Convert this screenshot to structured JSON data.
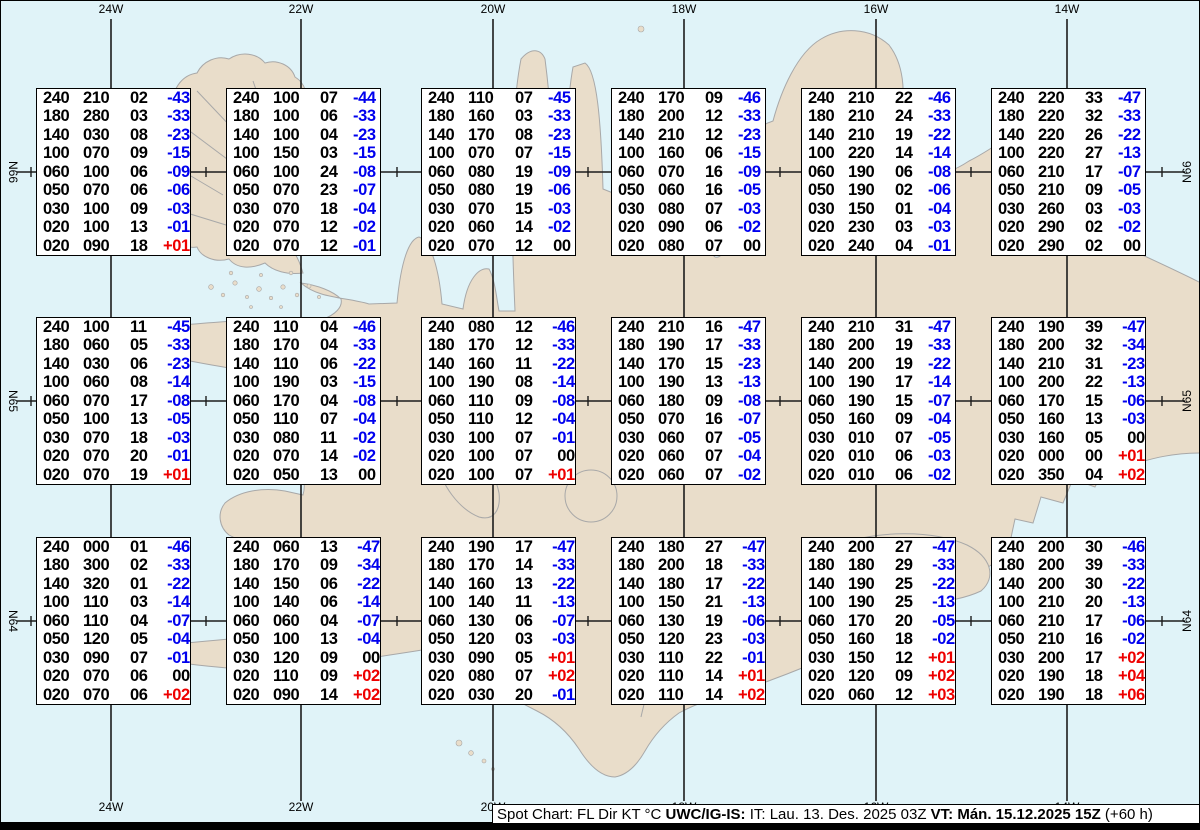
{
  "title": "Spot wind and temperature chart, Iceland",
  "colors": {
    "ocean": "#E0F3F8",
    "land": "#E9DDCA",
    "coast": "#A8A8A8",
    "grid": "#1C1C1C",
    "neg_temp": "#0000EE",
    "pos_temp": "#EE0000",
    "text": "#000000",
    "box_bg": "#FFFFFF",
    "frame": "#000000",
    "bar": "#000000"
  },
  "map": {
    "longitude_labels": [
      "24W",
      "22W",
      "20W",
      "18W",
      "16W",
      "14W"
    ],
    "longitudes_x": [
      110,
      300,
      492,
      683,
      875,
      1066
    ],
    "latitude_labels": [
      "N66",
      "N65",
      "N64"
    ],
    "latitudes_y": [
      171,
      400,
      620
    ],
    "tick_x": [
      30,
      205,
      396,
      587,
      779,
      970,
      1161
    ],
    "box_left_x": [
      35,
      225,
      420,
      610,
      800,
      990
    ],
    "box_top_y": [
      87,
      316,
      536
    ]
  },
  "legend": {
    "segments": [
      {
        "text": "Spot Chart: FL Dir KT °C ",
        "bold": false
      },
      {
        "text": "UWC/IG-IS:",
        "bold": true
      },
      {
        "text": " IT: Lau. 13. Des. 2025 03Z ",
        "bold": false
      },
      {
        "text": "VT: Mán. 15.12.2025 15Z",
        "bold": true
      },
      {
        "text": " (+60 h)",
        "bold": false
      }
    ]
  },
  "columns": [
    "FL",
    "Dir",
    "KT",
    "°C"
  ],
  "boxes": [
    {
      "row": 0,
      "col": 0,
      "rows": [
        [
          "240",
          "210",
          "02",
          "-43"
        ],
        [
          "180",
          "280",
          "03",
          "-33"
        ],
        [
          "140",
          "030",
          "08",
          "-23"
        ],
        [
          "100",
          "070",
          "09",
          "-15"
        ],
        [
          "060",
          "100",
          "06",
          "-09"
        ],
        [
          "050",
          "070",
          "06",
          "-06"
        ],
        [
          "030",
          "100",
          "09",
          "-03"
        ],
        [
          "020",
          "100",
          "13",
          "-01"
        ],
        [
          "020",
          "090",
          "18",
          "+01"
        ]
      ]
    },
    {
      "row": 0,
      "col": 1,
      "rows": [
        [
          "240",
          "100",
          "07",
          "-44"
        ],
        [
          "180",
          "100",
          "06",
          "-33"
        ],
        [
          "140",
          "100",
          "04",
          "-23"
        ],
        [
          "100",
          "150",
          "03",
          "-15"
        ],
        [
          "060",
          "100",
          "24",
          "-08"
        ],
        [
          "050",
          "070",
          "23",
          "-07"
        ],
        [
          "030",
          "070",
          "18",
          "-04"
        ],
        [
          "020",
          "070",
          "12",
          "-02"
        ],
        [
          "020",
          "070",
          "12",
          "-01"
        ]
      ]
    },
    {
      "row": 0,
      "col": 2,
      "rows": [
        [
          "240",
          "110",
          "07",
          "-45"
        ],
        [
          "180",
          "160",
          "03",
          "-33"
        ],
        [
          "140",
          "170",
          "08",
          "-23"
        ],
        [
          "100",
          "070",
          "07",
          "-15"
        ],
        [
          "060",
          "080",
          "19",
          "-09"
        ],
        [
          "050",
          "080",
          "19",
          "-06"
        ],
        [
          "030",
          "070",
          "15",
          "-03"
        ],
        [
          "020",
          "060",
          "14",
          "-02"
        ],
        [
          "020",
          "070",
          "12",
          "00"
        ]
      ]
    },
    {
      "row": 0,
      "col": 3,
      "rows": [
        [
          "240",
          "170",
          "09",
          "-46"
        ],
        [
          "180",
          "200",
          "12",
          "-33"
        ],
        [
          "140",
          "210",
          "12",
          "-23"
        ],
        [
          "100",
          "160",
          "06",
          "-15"
        ],
        [
          "060",
          "070",
          "16",
          "-09"
        ],
        [
          "050",
          "060",
          "16",
          "-05"
        ],
        [
          "030",
          "080",
          "07",
          "-03"
        ],
        [
          "020",
          "090",
          "06",
          "-02"
        ],
        [
          "020",
          "080",
          "07",
          "00"
        ]
      ]
    },
    {
      "row": 0,
      "col": 4,
      "rows": [
        [
          "240",
          "210",
          "22",
          "-46"
        ],
        [
          "180",
          "210",
          "24",
          "-33"
        ],
        [
          "140",
          "210",
          "19",
          "-22"
        ],
        [
          "100",
          "220",
          "14",
          "-14"
        ],
        [
          "060",
          "190",
          "06",
          "-08"
        ],
        [
          "050",
          "190",
          "02",
          "-06"
        ],
        [
          "030",
          "150",
          "01",
          "-04"
        ],
        [
          "020",
          "230",
          "03",
          "-03"
        ],
        [
          "020",
          "240",
          "04",
          "-01"
        ]
      ]
    },
    {
      "row": 0,
      "col": 5,
      "rows": [
        [
          "240",
          "220",
          "33",
          "-47"
        ],
        [
          "180",
          "220",
          "32",
          "-33"
        ],
        [
          "140",
          "220",
          "26",
          "-22"
        ],
        [
          "100",
          "220",
          "27",
          "-13"
        ],
        [
          "060",
          "210",
          "17",
          "-07"
        ],
        [
          "050",
          "210",
          "09",
          "-05"
        ],
        [
          "030",
          "260",
          "03",
          "-03"
        ],
        [
          "020",
          "290",
          "02",
          "-02"
        ],
        [
          "020",
          "290",
          "02",
          "00"
        ]
      ]
    },
    {
      "row": 1,
      "col": 0,
      "rows": [
        [
          "240",
          "100",
          "11",
          "-45"
        ],
        [
          "180",
          "060",
          "05",
          "-33"
        ],
        [
          "140",
          "030",
          "06",
          "-23"
        ],
        [
          "100",
          "060",
          "08",
          "-14"
        ],
        [
          "060",
          "070",
          "17",
          "-08"
        ],
        [
          "050",
          "100",
          "13",
          "-05"
        ],
        [
          "030",
          "070",
          "18",
          "-03"
        ],
        [
          "020",
          "070",
          "20",
          "-01"
        ],
        [
          "020",
          "070",
          "19",
          "+01"
        ]
      ]
    },
    {
      "row": 1,
      "col": 1,
      "rows": [
        [
          "240",
          "110",
          "04",
          "-46"
        ],
        [
          "180",
          "170",
          "04",
          "-33"
        ],
        [
          "140",
          "110",
          "06",
          "-22"
        ],
        [
          "100",
          "190",
          "03",
          "-15"
        ],
        [
          "060",
          "170",
          "04",
          "-08"
        ],
        [
          "050",
          "110",
          "07",
          "-04"
        ],
        [
          "030",
          "080",
          "11",
          "-02"
        ],
        [
          "020",
          "070",
          "14",
          "-02"
        ],
        [
          "020",
          "050",
          "13",
          "00"
        ]
      ]
    },
    {
      "row": 1,
      "col": 2,
      "rows": [
        [
          "240",
          "080",
          "12",
          "-46"
        ],
        [
          "180",
          "170",
          "12",
          "-33"
        ],
        [
          "140",
          "160",
          "11",
          "-22"
        ],
        [
          "100",
          "190",
          "08",
          "-14"
        ],
        [
          "060",
          "110",
          "09",
          "-08"
        ],
        [
          "050",
          "110",
          "12",
          "-04"
        ],
        [
          "030",
          "100",
          "07",
          "-01"
        ],
        [
          "020",
          "100",
          "07",
          "00"
        ],
        [
          "020",
          "100",
          "07",
          "+01"
        ]
      ]
    },
    {
      "row": 1,
      "col": 3,
      "rows": [
        [
          "240",
          "210",
          "16",
          "-47"
        ],
        [
          "180",
          "190",
          "17",
          "-33"
        ],
        [
          "140",
          "170",
          "15",
          "-23"
        ],
        [
          "100",
          "190",
          "13",
          "-13"
        ],
        [
          "060",
          "180",
          "09",
          "-08"
        ],
        [
          "050",
          "070",
          "16",
          "-07"
        ],
        [
          "030",
          "060",
          "07",
          "-05"
        ],
        [
          "020",
          "060",
          "07",
          "-04"
        ],
        [
          "020",
          "060",
          "07",
          "-02"
        ]
      ]
    },
    {
      "row": 1,
      "col": 4,
      "rows": [
        [
          "240",
          "210",
          "31",
          "-47"
        ],
        [
          "180",
          "200",
          "19",
          "-33"
        ],
        [
          "140",
          "200",
          "19",
          "-22"
        ],
        [
          "100",
          "190",
          "17",
          "-14"
        ],
        [
          "060",
          "190",
          "15",
          "-07"
        ],
        [
          "050",
          "160",
          "09",
          "-04"
        ],
        [
          "030",
          "010",
          "07",
          "-05"
        ],
        [
          "020",
          "010",
          "06",
          "-03"
        ],
        [
          "020",
          "010",
          "06",
          "-02"
        ]
      ]
    },
    {
      "row": 1,
      "col": 5,
      "rows": [
        [
          "240",
          "190",
          "39",
          "-47"
        ],
        [
          "180",
          "200",
          "32",
          "-34"
        ],
        [
          "140",
          "210",
          "31",
          "-23"
        ],
        [
          "100",
          "200",
          "22",
          "-13"
        ],
        [
          "060",
          "170",
          "15",
          "-06"
        ],
        [
          "050",
          "160",
          "13",
          "-03"
        ],
        [
          "030",
          "160",
          "05",
          "00"
        ],
        [
          "020",
          "000",
          "00",
          "+01"
        ],
        [
          "020",
          "350",
          "04",
          "+02"
        ]
      ]
    },
    {
      "row": 2,
      "col": 0,
      "rows": [
        [
          "240",
          "000",
          "01",
          "-46"
        ],
        [
          "180",
          "300",
          "02",
          "-33"
        ],
        [
          "140",
          "320",
          "01",
          "-22"
        ],
        [
          "100",
          "110",
          "03",
          "-14"
        ],
        [
          "060",
          "110",
          "04",
          "-07"
        ],
        [
          "050",
          "120",
          "05",
          "-04"
        ],
        [
          "030",
          "090",
          "07",
          "-01"
        ],
        [
          "020",
          "070",
          "06",
          "00"
        ],
        [
          "020",
          "070",
          "06",
          "+02"
        ]
      ]
    },
    {
      "row": 2,
      "col": 1,
      "rows": [
        [
          "240",
          "060",
          "13",
          "-47"
        ],
        [
          "180",
          "170",
          "09",
          "-34"
        ],
        [
          "140",
          "150",
          "06",
          "-22"
        ],
        [
          "100",
          "140",
          "06",
          "-14"
        ],
        [
          "060",
          "060",
          "04",
          "-07"
        ],
        [
          "050",
          "100",
          "13",
          "-04"
        ],
        [
          "030",
          "120",
          "09",
          "00"
        ],
        [
          "020",
          "110",
          "09",
          "+02"
        ],
        [
          "020",
          "090",
          "14",
          "+02"
        ]
      ]
    },
    {
      "row": 2,
      "col": 2,
      "rows": [
        [
          "240",
          "190",
          "17",
          "-47"
        ],
        [
          "180",
          "170",
          "14",
          "-33"
        ],
        [
          "140",
          "160",
          "13",
          "-22"
        ],
        [
          "100",
          "140",
          "11",
          "-13"
        ],
        [
          "060",
          "130",
          "06",
          "-07"
        ],
        [
          "050",
          "120",
          "03",
          "-03"
        ],
        [
          "030",
          "090",
          "05",
          "+01"
        ],
        [
          "020",
          "080",
          "07",
          "+02"
        ],
        [
          "020",
          "030",
          "20",
          "-01"
        ]
      ]
    },
    {
      "row": 2,
      "col": 3,
      "rows": [
        [
          "240",
          "180",
          "27",
          "-47"
        ],
        [
          "180",
          "200",
          "18",
          "-33"
        ],
        [
          "140",
          "180",
          "17",
          "-22"
        ],
        [
          "100",
          "150",
          "21",
          "-13"
        ],
        [
          "060",
          "130",
          "19",
          "-06"
        ],
        [
          "050",
          "120",
          "23",
          "-03"
        ],
        [
          "030",
          "110",
          "22",
          "-01"
        ],
        [
          "020",
          "110",
          "14",
          "+01"
        ],
        [
          "020",
          "110",
          "14",
          "+02"
        ]
      ]
    },
    {
      "row": 2,
      "col": 4,
      "rows": [
        [
          "240",
          "200",
          "27",
          "-47"
        ],
        [
          "180",
          "180",
          "29",
          "-33"
        ],
        [
          "140",
          "190",
          "25",
          "-22"
        ],
        [
          "100",
          "190",
          "25",
          "-13"
        ],
        [
          "060",
          "170",
          "20",
          "-05"
        ],
        [
          "050",
          "160",
          "18",
          "-02"
        ],
        [
          "030",
          "150",
          "12",
          "+01"
        ],
        [
          "020",
          "120",
          "09",
          "+02"
        ],
        [
          "020",
          "060",
          "12",
          "+03"
        ]
      ]
    },
    {
      "row": 2,
      "col": 5,
      "rows": [
        [
          "240",
          "200",
          "30",
          "-46"
        ],
        [
          "180",
          "200",
          "39",
          "-33"
        ],
        [
          "140",
          "200",
          "30",
          "-22"
        ],
        [
          "100",
          "210",
          "20",
          "-13"
        ],
        [
          "060",
          "210",
          "17",
          "-06"
        ],
        [
          "050",
          "210",
          "16",
          "-02"
        ],
        [
          "030",
          "200",
          "17",
          "+02"
        ],
        [
          "020",
          "190",
          "18",
          "+04"
        ],
        [
          "020",
          "190",
          "18",
          "+06"
        ]
      ]
    }
  ]
}
